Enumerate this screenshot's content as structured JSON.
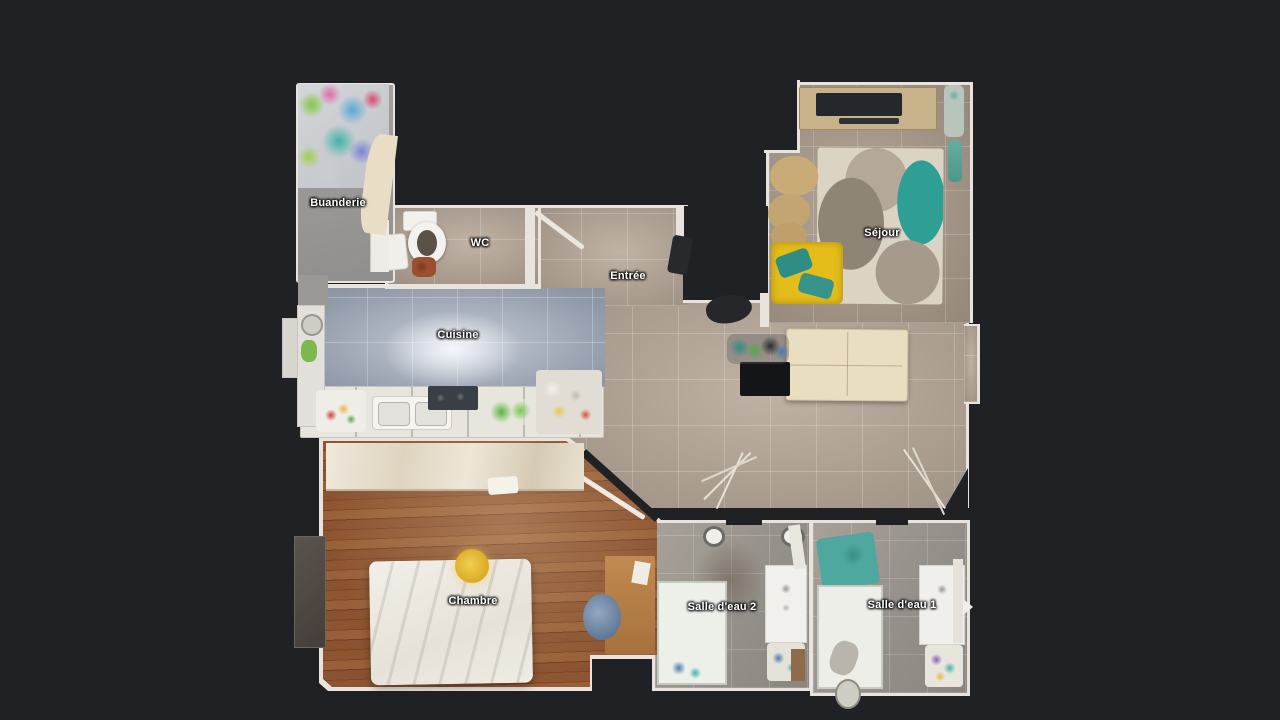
{
  "view": {
    "type": "floor-plan-top-view",
    "background_color": "#1f2125"
  },
  "floorplan": {
    "rooms": [
      {
        "id": "buanderie",
        "label": "Buanderie"
      },
      {
        "id": "wc",
        "label": "WC"
      },
      {
        "id": "entree",
        "label": "Entrée"
      },
      {
        "id": "sejour",
        "label": "Séjour"
      },
      {
        "id": "cuisine",
        "label": "Cuisine"
      },
      {
        "id": "chambre",
        "label": "Chambre"
      },
      {
        "id": "salle_deau_2",
        "label": "Salle d'eau 2"
      },
      {
        "id": "salle_deau_1",
        "label": "Salle d'eau 1"
      }
    ],
    "colors": {
      "background": "#1f2125",
      "wall": "#e8e4dd",
      "tile_corridor": "#ab9e91",
      "tile_sejour": "#a29588",
      "tile_kitchen": "#a7aebc",
      "tile_bathroom": "#95908a",
      "wood_bedroom": "#8a5230",
      "rug_cream": "#dbd3c4",
      "rug_teal": "#2f9e95",
      "sofa_yellow": "#e4bd1b",
      "sofa_cushion_teal": "#2e8e85",
      "table_wood": "#eadec0",
      "bed_white": "#f0ede7"
    }
  }
}
